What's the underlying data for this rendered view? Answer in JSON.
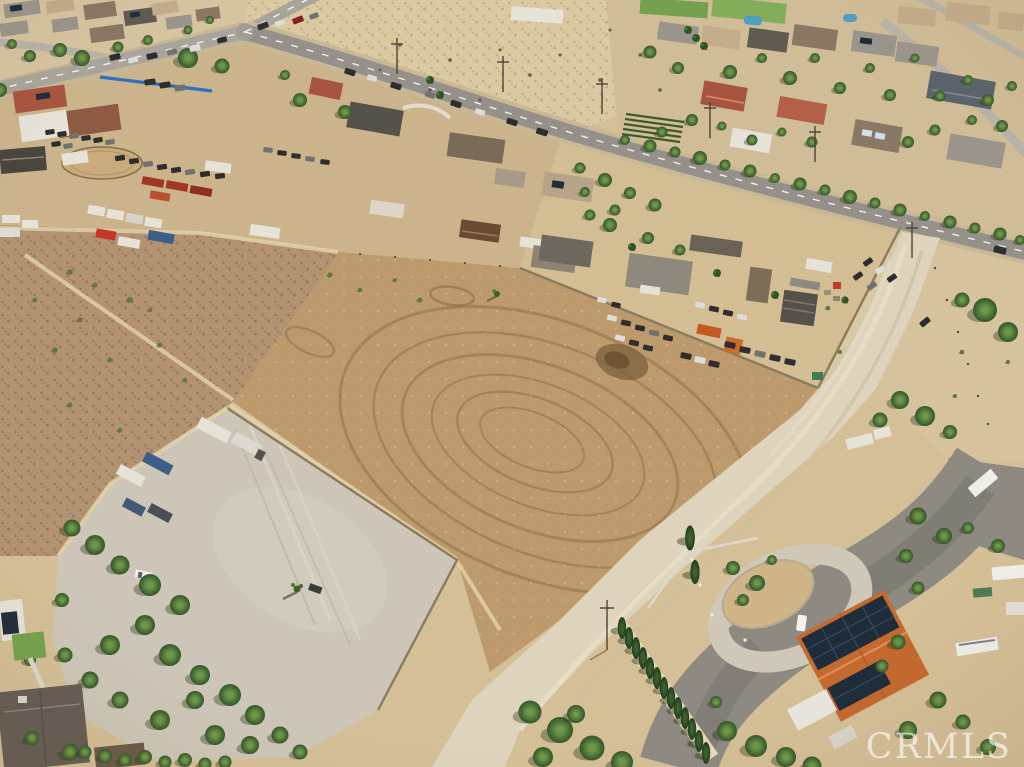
{
  "image": {
    "kind": "aerial-drone-photograph",
    "width_px": 1024,
    "height_px": 767,
    "subject": "vacant desert land parcels beside rural residential neighborhood"
  },
  "watermark": {
    "text": "CRMLS"
  },
  "palette": {
    "sand": "#d4bf97",
    "field": "#bd9a6c",
    "scrub": "#b29270",
    "graylot": "#cdc6b8",
    "dirtroad": "#ded3bc",
    "asphalt": "#8e8a82",
    "road": "#95918a",
    "roadlight": "#a9a59c",
    "wall": "#8a7a5f",
    "tree": "#3f6830",
    "cypress": "#2e4d26",
    "rooforange": "#c4692f",
    "roofred": "#a85540",
    "solar": "#1f2c3a",
    "pool": "#4f9fc4",
    "lawn": "#75a14e",
    "container_red": "#a33524",
    "container_orange": "#c45a20",
    "container_blue": "#3d5e88",
    "tarp_blue": "#2f6fc0"
  }
}
